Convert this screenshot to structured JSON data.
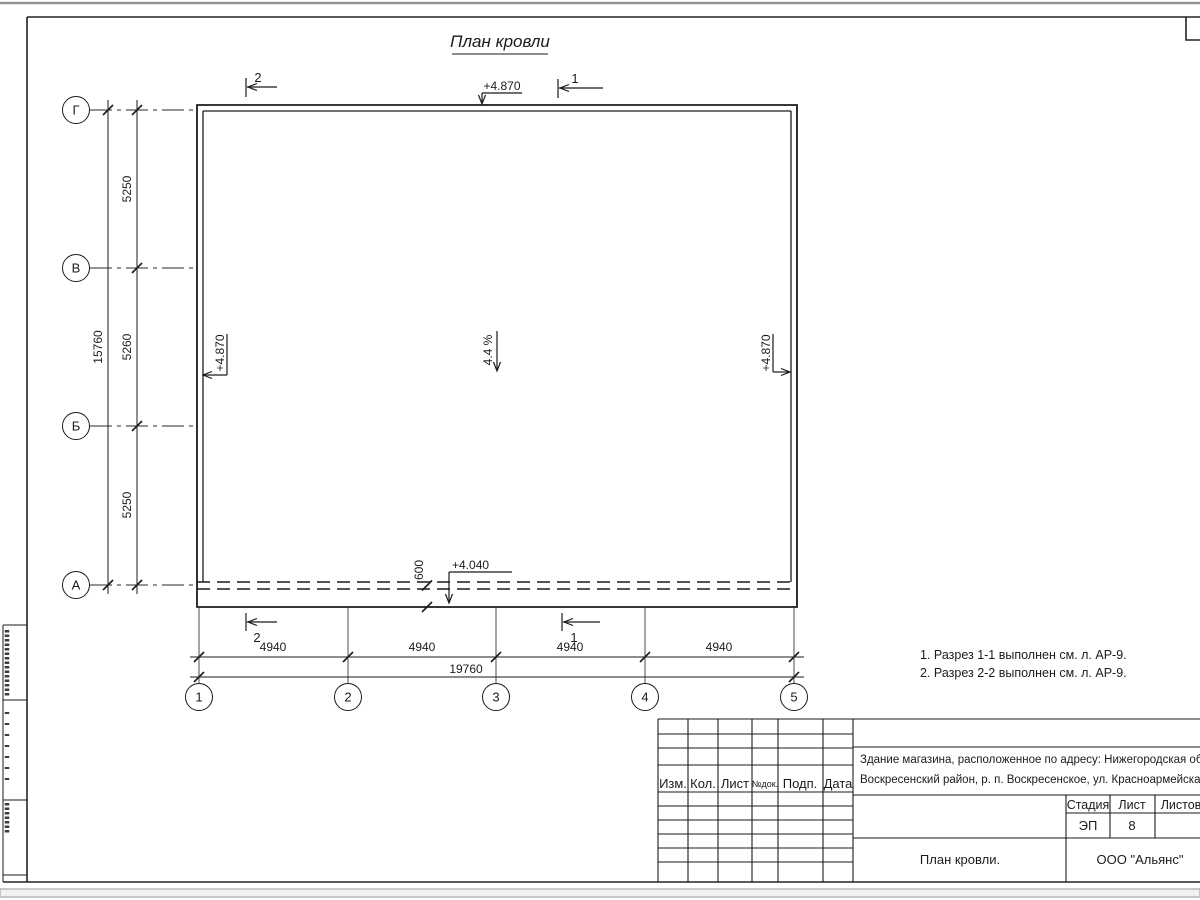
{
  "drawing": {
    "title": "План кровли",
    "axes_h": [
      "Г",
      "В",
      "Б",
      "А"
    ],
    "axes_v": [
      "1",
      "2",
      "3",
      "4",
      "5"
    ],
    "dims": {
      "v_segments": [
        "5250",
        "5260",
        "5250"
      ],
      "v_total": "15760",
      "h_segments": [
        "4940",
        "4940",
        "4940",
        "4940"
      ],
      "h_total": "19760",
      "overhang": "600"
    },
    "elevations": {
      "top": "+4.870",
      "left": "+4.870",
      "right": "+4.870",
      "eave": "+4.040"
    },
    "slope": "4.4 %",
    "sections": {
      "top_2": "2",
      "top_1": "1",
      "bottom_2": "2",
      "bottom_1": "1"
    },
    "notes": [
      "1. Разрез 1-1 выполнен см. л. АР-9.",
      "2. Разрез 2-2 выполнен см. л. АР-9."
    ]
  },
  "title_block": {
    "rev_headers": [
      "Изм.",
      "Кол.",
      "Лист",
      "№док.",
      "Подп.",
      "Дата"
    ],
    "project_line1": "Здание магазина, расположенное по адресу: Нижегородская область,",
    "project_line2": "Воскресенский район, р. п. Воскресенское, ул. Красноармейская, д. 1",
    "stage_label": "Стадия",
    "sheet_label": "Лист",
    "sheets_label": "Листов",
    "stage_value": "ЭП",
    "sheet_value": "8",
    "doc_title": "План кровли.",
    "company": "ООО \"Альянс\""
  }
}
